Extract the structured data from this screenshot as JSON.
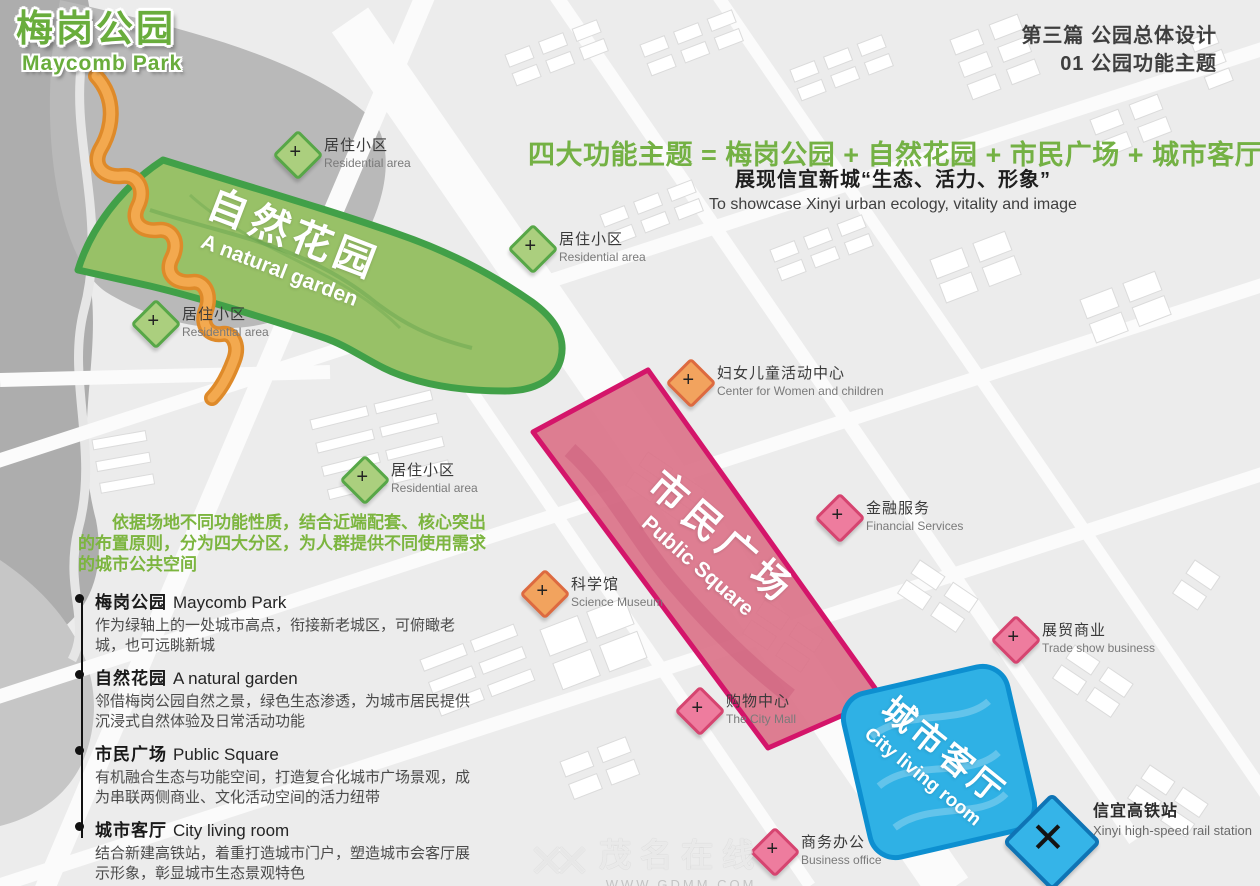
{
  "title": {
    "zh": "梅岗公园",
    "en": "Maycomb Park"
  },
  "section_header": {
    "line1": "第三篇 公园总体设计",
    "line2": "01 公园功能主题"
  },
  "headline": {
    "text": "四大功能主题 = 梅岗公园 + 自然花园 + 市民广场 + 城市客厅",
    "sub_zh": "展现信宜新城“生态、活力、形象”",
    "sub_en": "To showcase Xinyi urban ecology, vitality and image"
  },
  "intro": "依据场地不同功能性质，结合近端配套、核心突出的布置原则，分为四大分区，为人群提供不同使用需求的城市公共空间",
  "legend_items": [
    {
      "title_zh": "梅岗公园",
      "title_en": "Maycomb Park",
      "desc": "作为绿轴上的一处城市高点，衔接新老城区，可俯瞰老城，也可远眺新城"
    },
    {
      "title_zh": "自然花园",
      "title_en": "A natural garden",
      "desc": "邻借梅岗公园自然之景，绿色生态渗透，为城市居民提供沉浸式自然体验及日常活动功能"
    },
    {
      "title_zh": "市民广场",
      "title_en": "Public Square",
      "desc": "有机融合生态与功能空间，打造复合化城市广场景观，成为串联两侧商业、文化活动空间的活力纽带"
    },
    {
      "title_zh": "城市客厅",
      "title_en": "City living room",
      "desc": "结合新建高铁站，着重打造城市门户，塑造城市会客厅展示形象，彰显城市生态景观特色"
    }
  ],
  "zones": [
    {
      "zh": "自然花园",
      "en": "A natural garden",
      "fill": "#98C167",
      "border": "#41A048"
    },
    {
      "zh": "市民广场",
      "en": "Public Square",
      "fill": "#DB7389",
      "border": "#D4156A"
    },
    {
      "zh": "城市客厅",
      "en": "City living room",
      "fill": "#2FB1E5",
      "border": "#0D8FD0"
    }
  ],
  "markers": [
    {
      "zh": "居住小区",
      "en": "Residential area",
      "type": "green"
    },
    {
      "zh": "居住小区",
      "en": "Residential area",
      "type": "green"
    },
    {
      "zh": "居住小区",
      "en": "Residential area",
      "type": "green"
    },
    {
      "zh": "居住小区",
      "en": "Residential area",
      "type": "green"
    },
    {
      "zh": "妇女儿童活动中心",
      "en": "Center for Women and children",
      "type": "orange"
    },
    {
      "zh": "金融服务",
      "en": "Financial Services",
      "type": "pink"
    },
    {
      "zh": "科学馆",
      "en": "Science Museum",
      "type": "orange"
    },
    {
      "zh": "展贸商业",
      "en": "Trade show business",
      "type": "pink"
    },
    {
      "zh": "购物中心",
      "en": "The City Mall",
      "type": "pink"
    },
    {
      "zh": "商务办公",
      "en": "Business office",
      "type": "pink"
    },
    {
      "zh": "信宜高铁站",
      "en": "Xinyi high-speed rail station",
      "type": "rail"
    }
  ],
  "icons": {
    "plus": "+",
    "cross": "✕",
    "watermark_mark": "✕✕"
  },
  "watermark": {
    "name": "茂名在线",
    "url": "WWW.GDMM.COM"
  },
  "colors": {
    "theme_green": "#74B144",
    "marker_green": "#ABCF7E",
    "marker_orange": "#F2A35E",
    "marker_pink": "#EE7C9E",
    "rail_blue": "#35B4E8",
    "trail_orange": "#E8912D"
  }
}
